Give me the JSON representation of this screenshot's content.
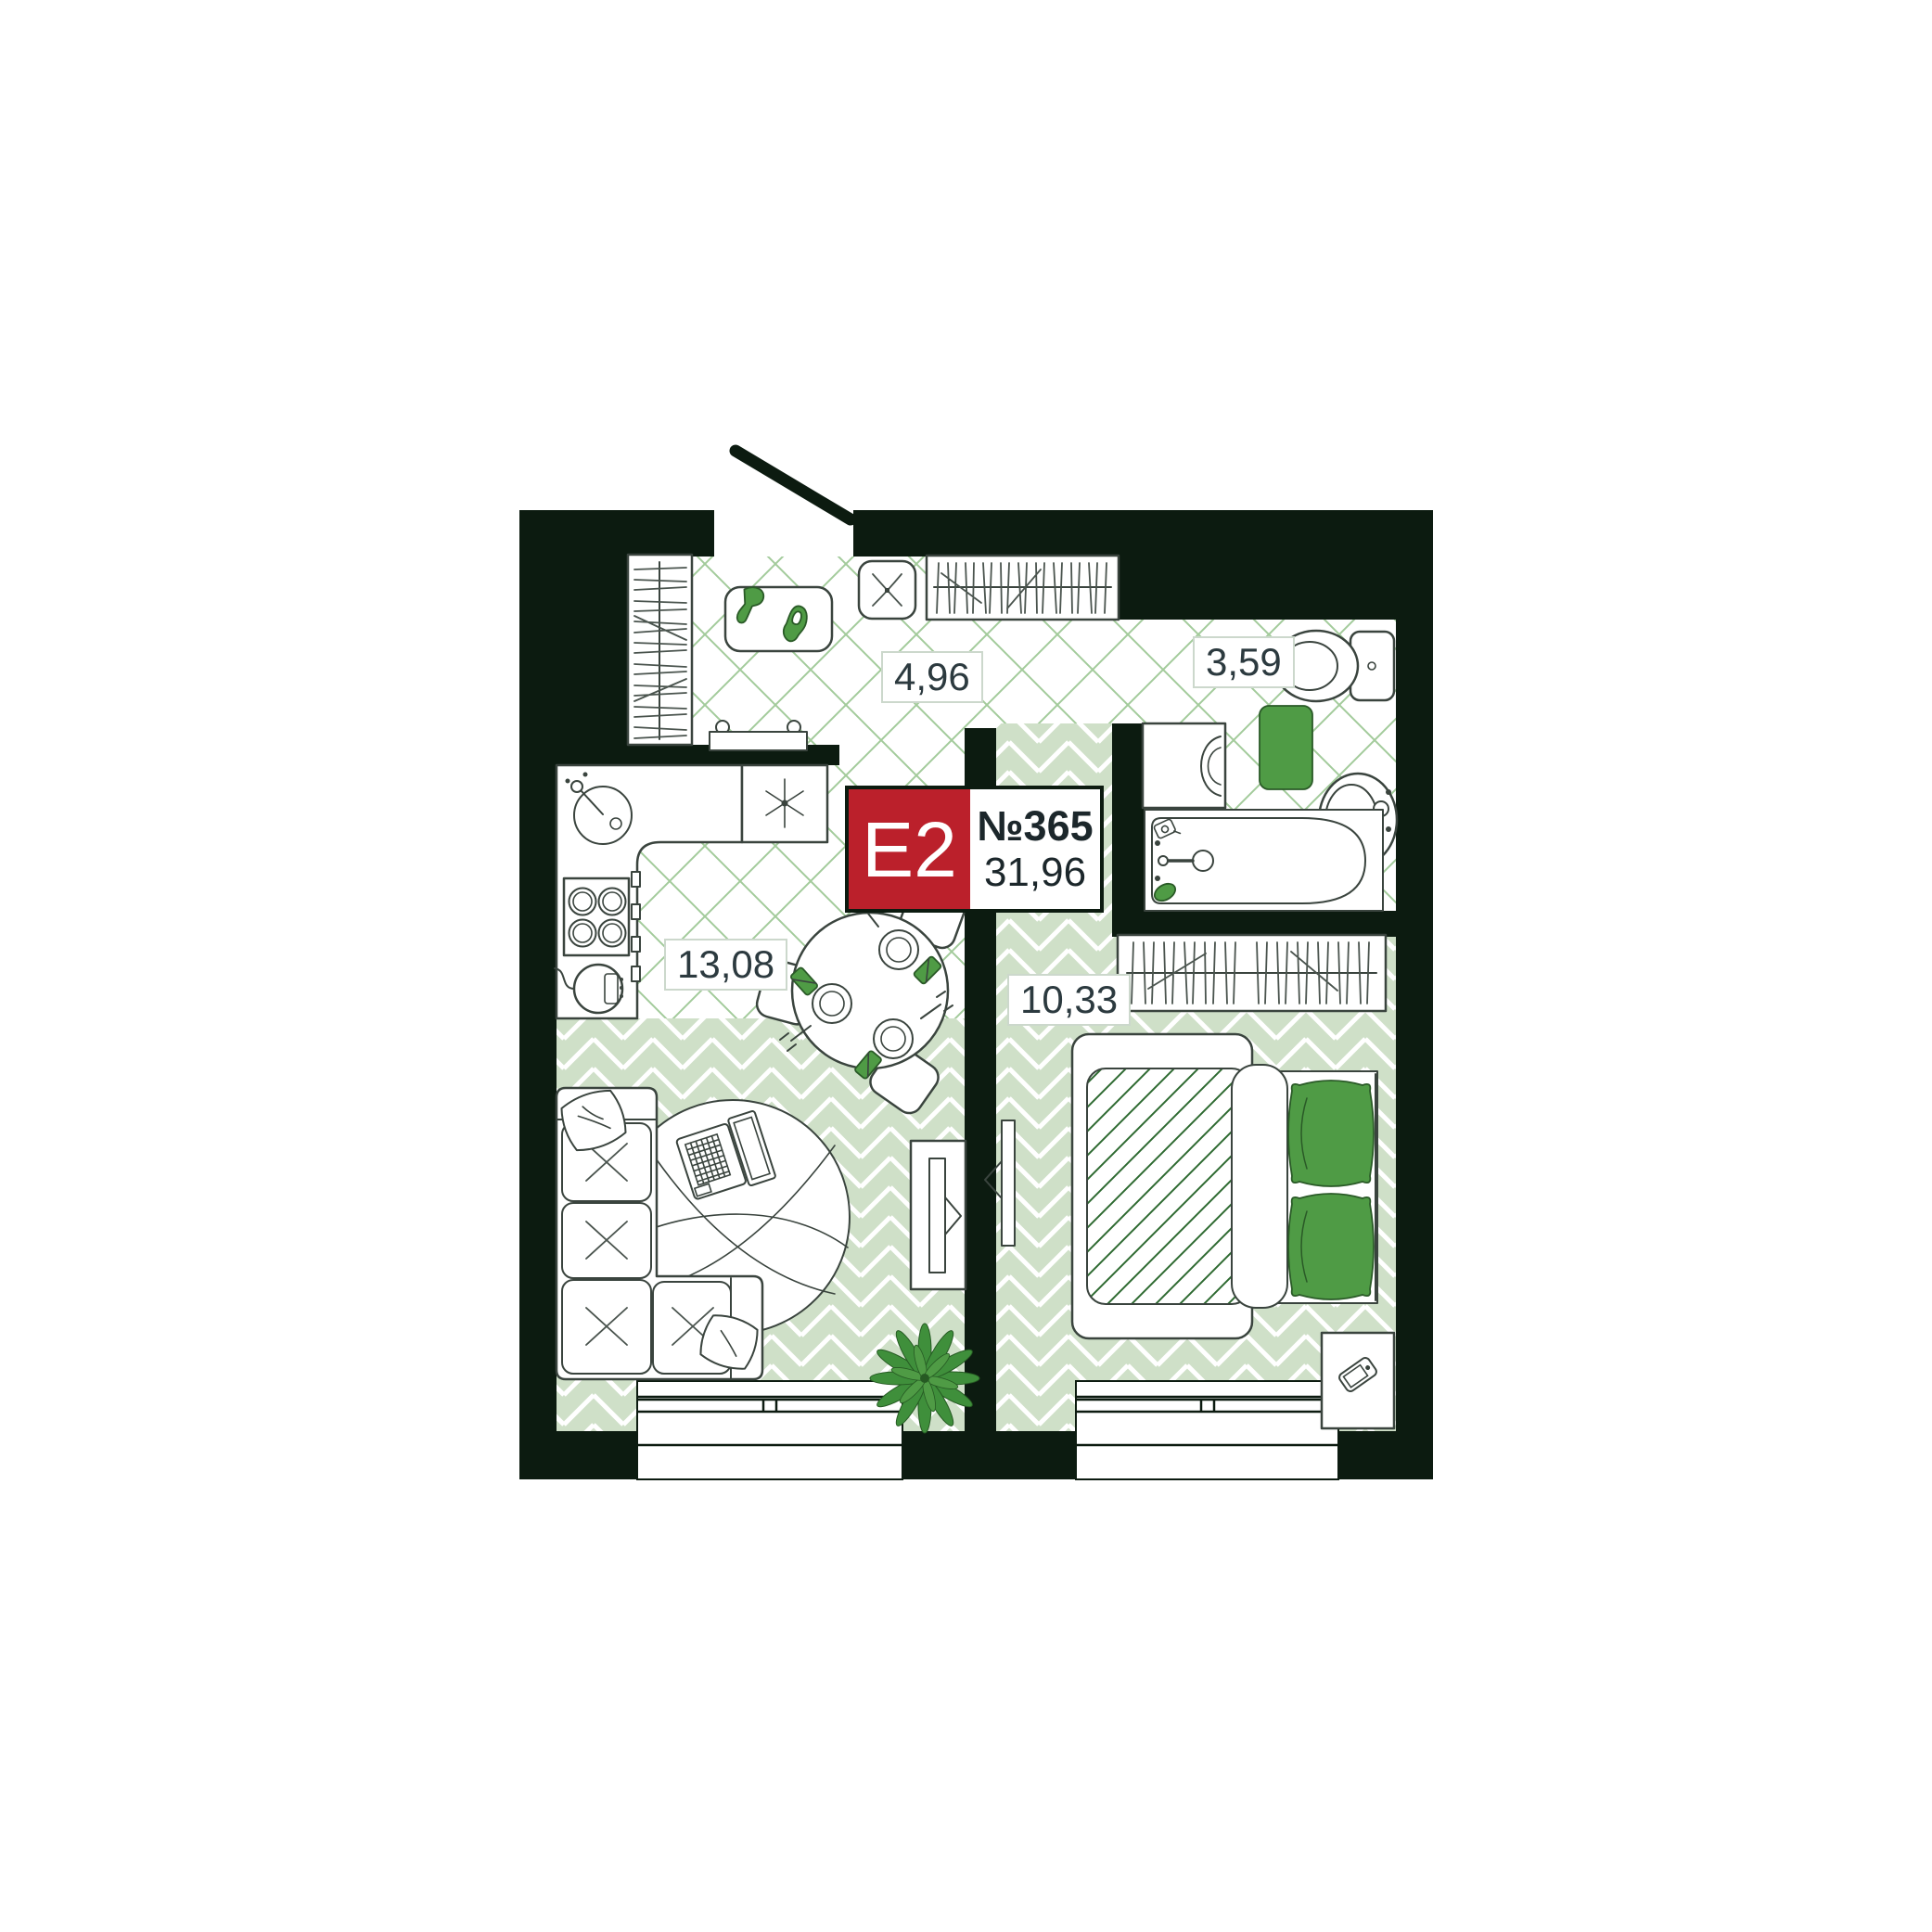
{
  "badge": {
    "plan_type": "Е2",
    "unit_number": "№365",
    "total_area": "31,96",
    "color": "#bb202b"
  },
  "rooms": {
    "hallway": {
      "area": "4,96"
    },
    "bathroom": {
      "area": "3,59"
    },
    "kitchen_living_room": {
      "area": "13,08"
    },
    "bedroom": {
      "area": "10,33"
    }
  },
  "colors": {
    "walls": "#0c1b10",
    "accent_green": "#4f9b45",
    "floor_light_green": "#cfe0c8",
    "floor_hatch_green": "#a3cb9b",
    "badge_red": "#bb202b"
  },
  "icons": {
    "entrance_door": "door-swing",
    "furniture": [
      "wardrobe",
      "shoe-mat",
      "pouf",
      "radiator",
      "kitchen-sink",
      "stove",
      "kettle",
      "fridge",
      "dining-table",
      "sofa",
      "rug",
      "laptop",
      "tv",
      "plant",
      "bed",
      "pillows",
      "nightstand",
      "phone",
      "toilet",
      "wash-basin",
      "washing-machine",
      "bathtub",
      "bath-mat",
      "window"
    ]
  }
}
